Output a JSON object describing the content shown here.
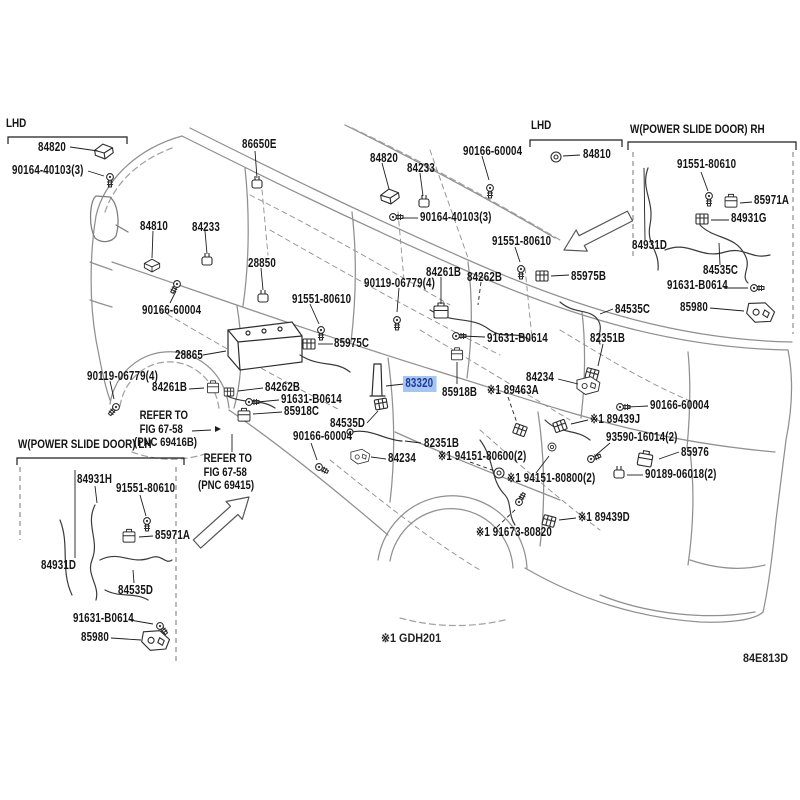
{
  "diagram": {
    "code": "84E813D",
    "footnote": "※1 GDH201",
    "highlight_bg": "#a5c6f1",
    "highlight_fg": "#20389f"
  },
  "annotations": {
    "lhd_left": "LHD",
    "lhd_mid": "LHD",
    "rh_box_title": "W(POWER SLIDE DOOR) RH",
    "lh_box_title": "W(POWER SLIDE DOOR) LH",
    "refer_1": [
      "REFER TO",
      "FIG 67-58",
      "(PNC 69416B)"
    ],
    "refer_2": [
      "REFER TO",
      "FIG 67-58",
      "(PNC 69415)"
    ]
  },
  "labels": [
    {
      "part": "84820",
      "text": "84820",
      "x": 38,
      "y": 141
    },
    {
      "part": "90164-40103",
      "text": "90164-40103(3)",
      "x": 12,
      "y": 164
    },
    {
      "part": "86650E",
      "text": "86650E",
      "x": 242,
      "y": 138
    },
    {
      "part": "84810",
      "text": "84810",
      "x": 140,
      "y": 220
    },
    {
      "part": "84233",
      "text": "84233",
      "x": 192,
      "y": 221
    },
    {
      "part": "84820",
      "text": "84820",
      "x": 370,
      "y": 152
    },
    {
      "part": "84233",
      "text": "84233",
      "x": 407,
      "y": 162
    },
    {
      "part": "90166-60004",
      "text": "90166-60004",
      "x": 463,
      "y": 145
    },
    {
      "part": "90164-40103",
      "text": "90164-40103(3)",
      "x": 420,
      "y": 211
    },
    {
      "part": "84810",
      "text": "84810",
      "x": 583,
      "y": 148
    },
    {
      "part": "91551-80610",
      "text": "91551-80610",
      "x": 492,
      "y": 235
    },
    {
      "part": "91551-80610",
      "text": "91551-80610",
      "x": 677,
      "y": 158
    },
    {
      "part": "85971A",
      "text": "85971A",
      "x": 754,
      "y": 194
    },
    {
      "part": "84931G",
      "text": "84931G",
      "x": 731,
      "y": 212
    },
    {
      "part": "84931D",
      "text": "84931D",
      "x": 632,
      "y": 239
    },
    {
      "part": "84535C",
      "text": "84535C",
      "x": 703,
      "y": 264
    },
    {
      "part": "91631-B0614",
      "text": "91631-B0614",
      "x": 667,
      "y": 279
    },
    {
      "part": "85980",
      "text": "85980",
      "x": 680,
      "y": 301
    },
    {
      "part": "28850",
      "text": "28850",
      "x": 248,
      "y": 257
    },
    {
      "part": "90166-60004",
      "text": "90166-60004",
      "x": 142,
      "y": 304
    },
    {
      "part": "28865",
      "text": "28865",
      "x": 175,
      "y": 349
    },
    {
      "part": "91551-80610",
      "text": "91551-80610",
      "x": 292,
      "y": 293
    },
    {
      "part": "85975C",
      "text": "85975C",
      "x": 334,
      "y": 337
    },
    {
      "part": "90119-06779",
      "text": "90119-06779(4)",
      "x": 87,
      "y": 370
    },
    {
      "part": "84261B",
      "text": "84261B",
      "x": 152,
      "y": 381
    },
    {
      "part": "84262B",
      "text": "84262B",
      "x": 265,
      "y": 381
    },
    {
      "part": "91631-B0614",
      "text": "91631-B0614",
      "x": 281,
      "y": 393
    },
    {
      "part": "85918C",
      "text": "85918C",
      "x": 284,
      "y": 405
    },
    {
      "part": "90119-06779",
      "text": "90119-06779(4)",
      "x": 364,
      "y": 277
    },
    {
      "part": "84261B",
      "text": "84261B",
      "x": 426,
      "y": 266
    },
    {
      "part": "84262B",
      "text": "84262B",
      "x": 467,
      "y": 271
    },
    {
      "part": "85975B",
      "text": "85975B",
      "x": 571,
      "y": 270
    },
    {
      "part": "84535C",
      "text": "84535C",
      "x": 615,
      "y": 303
    },
    {
      "part": "91631-B0614",
      "text": "91631-B0614",
      "x": 487,
      "y": 332
    },
    {
      "part": "82351B",
      "text": "82351B",
      "x": 590,
      "y": 332
    },
    {
      "part": "83320",
      "text": "83320",
      "x": 406,
      "y": 378,
      "hl": true
    },
    {
      "part": "85918B",
      "text": "85918B",
      "x": 442,
      "y": 386
    },
    {
      "part": "89463A",
      "text": "※1 89463A",
      "x": 487,
      "y": 384
    },
    {
      "part": "84234",
      "text": "84234",
      "x": 526,
      "y": 371
    },
    {
      "part": "84535D",
      "text": "84535D",
      "x": 330,
      "y": 417
    },
    {
      "part": "90166-60004",
      "text": "90166-60004",
      "x": 293,
      "y": 430
    },
    {
      "part": "82351B",
      "text": "82351B",
      "x": 424,
      "y": 437
    },
    {
      "part": "84234",
      "text": "84234",
      "x": 388,
      "y": 452
    },
    {
      "part": "94151-80600",
      "text": "※1 94151-80600(2)",
      "x": 438,
      "y": 450
    },
    {
      "part": "90166-60004",
      "text": "90166-60004",
      "x": 650,
      "y": 399
    },
    {
      "part": "89439J",
      "text": "※1 89439J",
      "x": 590,
      "y": 413
    },
    {
      "part": "93590-16014",
      "text": "93590-16014(2)",
      "x": 606,
      "y": 431
    },
    {
      "part": "85976",
      "text": "85976",
      "x": 681,
      "y": 446
    },
    {
      "part": "90189-06018",
      "text": "90189-06018(2)",
      "x": 645,
      "y": 468
    },
    {
      "part": "94151-80800",
      "text": "※1 94151-80800(2)",
      "x": 507,
      "y": 472
    },
    {
      "part": "89439D",
      "text": "※1 89439D",
      "x": 578,
      "y": 511
    },
    {
      "part": "91673-80820",
      "text": "※1 91673-80820",
      "x": 476,
      "y": 526
    },
    {
      "part": "84931H",
      "text": "84931H",
      "x": 77,
      "y": 473
    },
    {
      "part": "91551-80610",
      "text": "91551-80610",
      "x": 116,
      "y": 482
    },
    {
      "part": "85971A",
      "text": "85971A",
      "x": 155,
      "y": 529
    },
    {
      "part": "84931D",
      "text": "84931D",
      "x": 41,
      "y": 559
    },
    {
      "part": "84535D",
      "text": "84535D",
      "x": 118,
      "y": 584
    },
    {
      "part": "91631-B0614",
      "text": "91631-B0614",
      "x": 73,
      "y": 612
    },
    {
      "part": "85980",
      "text": "85980",
      "x": 81,
      "y": 631
    }
  ]
}
